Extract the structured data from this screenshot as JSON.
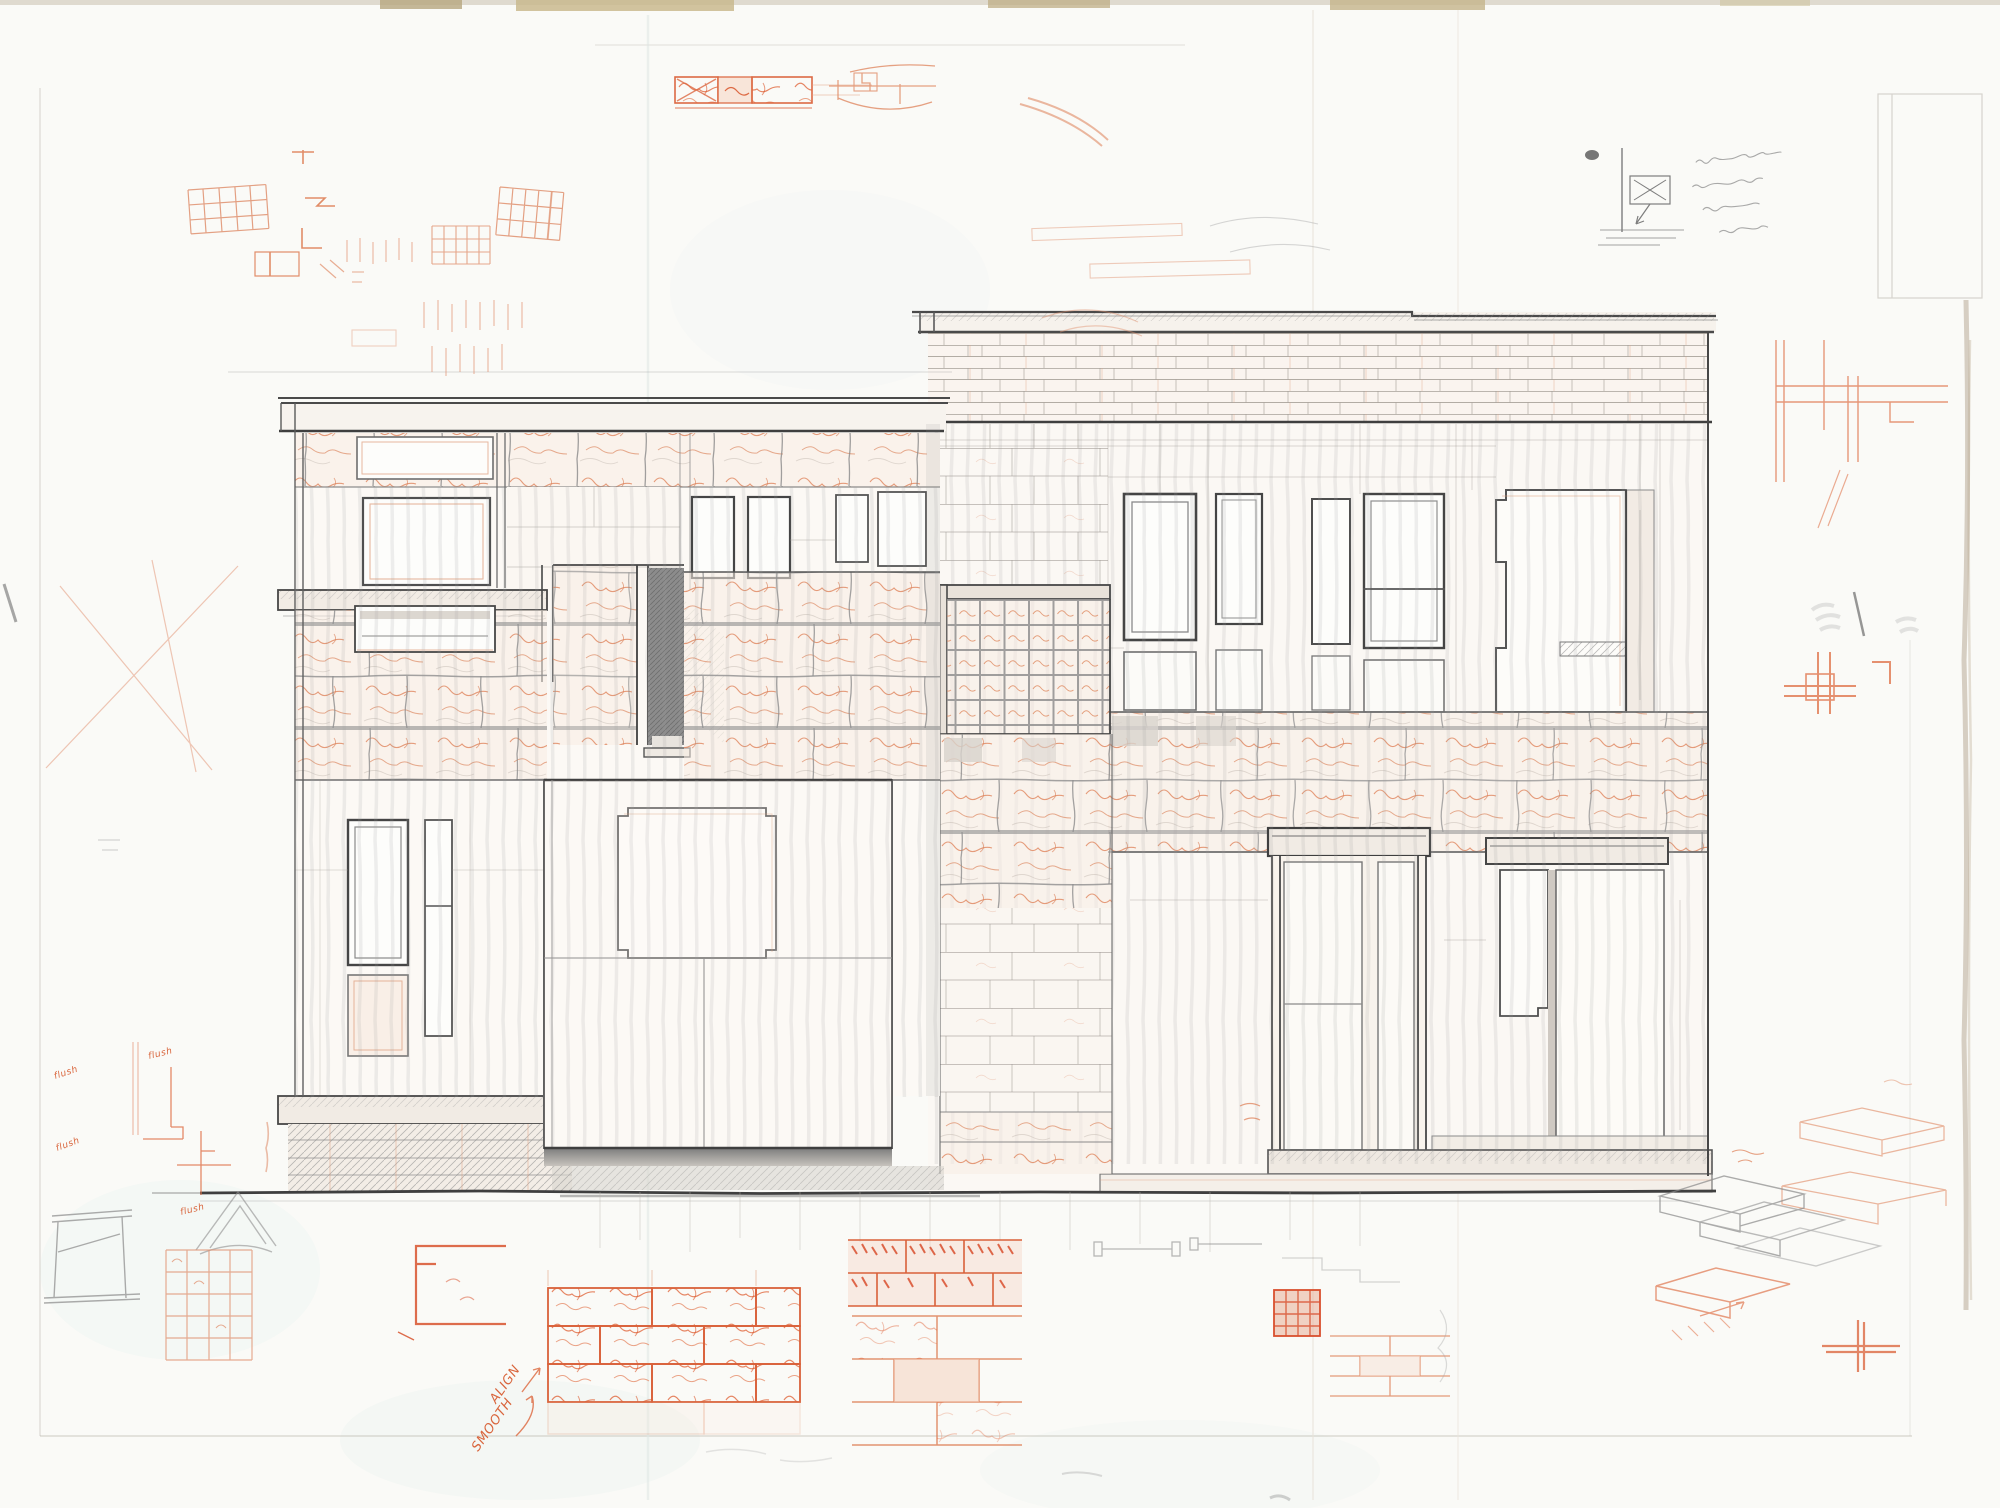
{
  "annotations": {
    "align_label": "ALIGN",
    "smooth_label": "SMOOTH",
    "flush_label": "flush",
    "pencil_note": "(illegible)",
    "tiny_note": "(illegible)"
  },
  "palette": {
    "paper": "#fafaf7",
    "graphite_light": "#9a9a9a",
    "graphite": "#6e6e6e",
    "graphite_dark": "#454545",
    "orange": "#e08a64",
    "orange_strong": "#d9653c",
    "red_orange": "#d94f2e",
    "stone_tint": "#f7ebe2",
    "shadow": "#8f8f8f",
    "cyan_tint": "#e6f2ef",
    "tape": "#c4b282"
  }
}
